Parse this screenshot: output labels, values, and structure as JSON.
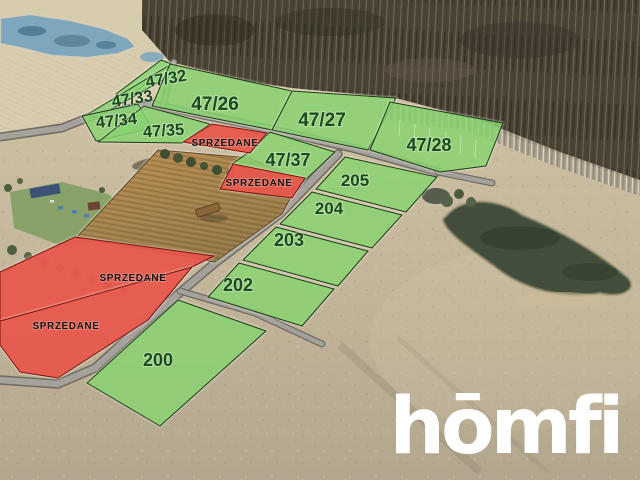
{
  "branding": {
    "logo_text": "hōmfi",
    "logo_color": "#ffffff"
  },
  "legend_colors": {
    "available_fill": "#5ec340",
    "sold_fill": "#e23a2d",
    "available_label_color": "#1b4a1e",
    "sold_label_color": "#151210"
  },
  "plots": {
    "p4732": {
      "label": "47/32",
      "status": "available"
    },
    "p4733": {
      "label": "47/33",
      "status": "available"
    },
    "p4734": {
      "label": "47/34",
      "status": "available"
    },
    "p4735": {
      "label": "47/35",
      "status": "available"
    },
    "p4726": {
      "label": "47/26",
      "status": "available"
    },
    "p4727": {
      "label": "47/27",
      "status": "available"
    },
    "p4728": {
      "label": "47/28",
      "status": "available"
    },
    "p4737": {
      "label": "47/37",
      "status": "available"
    },
    "p205": {
      "label": "205",
      "status": "available"
    },
    "p204": {
      "label": "204",
      "status": "available"
    },
    "p203": {
      "label": "203",
      "status": "available"
    },
    "p202": {
      "label": "202",
      "status": "available"
    },
    "p200": {
      "label": "200",
      "status": "available"
    },
    "sold1": {
      "label": "SPRZEDANE",
      "status": "sold"
    },
    "sold2": {
      "label": "SPRZEDANE",
      "status": "sold"
    },
    "sold3": {
      "label": "SPRZEDANE",
      "status": "sold"
    },
    "sold4": {
      "label": "SPRZEDANE",
      "status": "sold"
    }
  }
}
